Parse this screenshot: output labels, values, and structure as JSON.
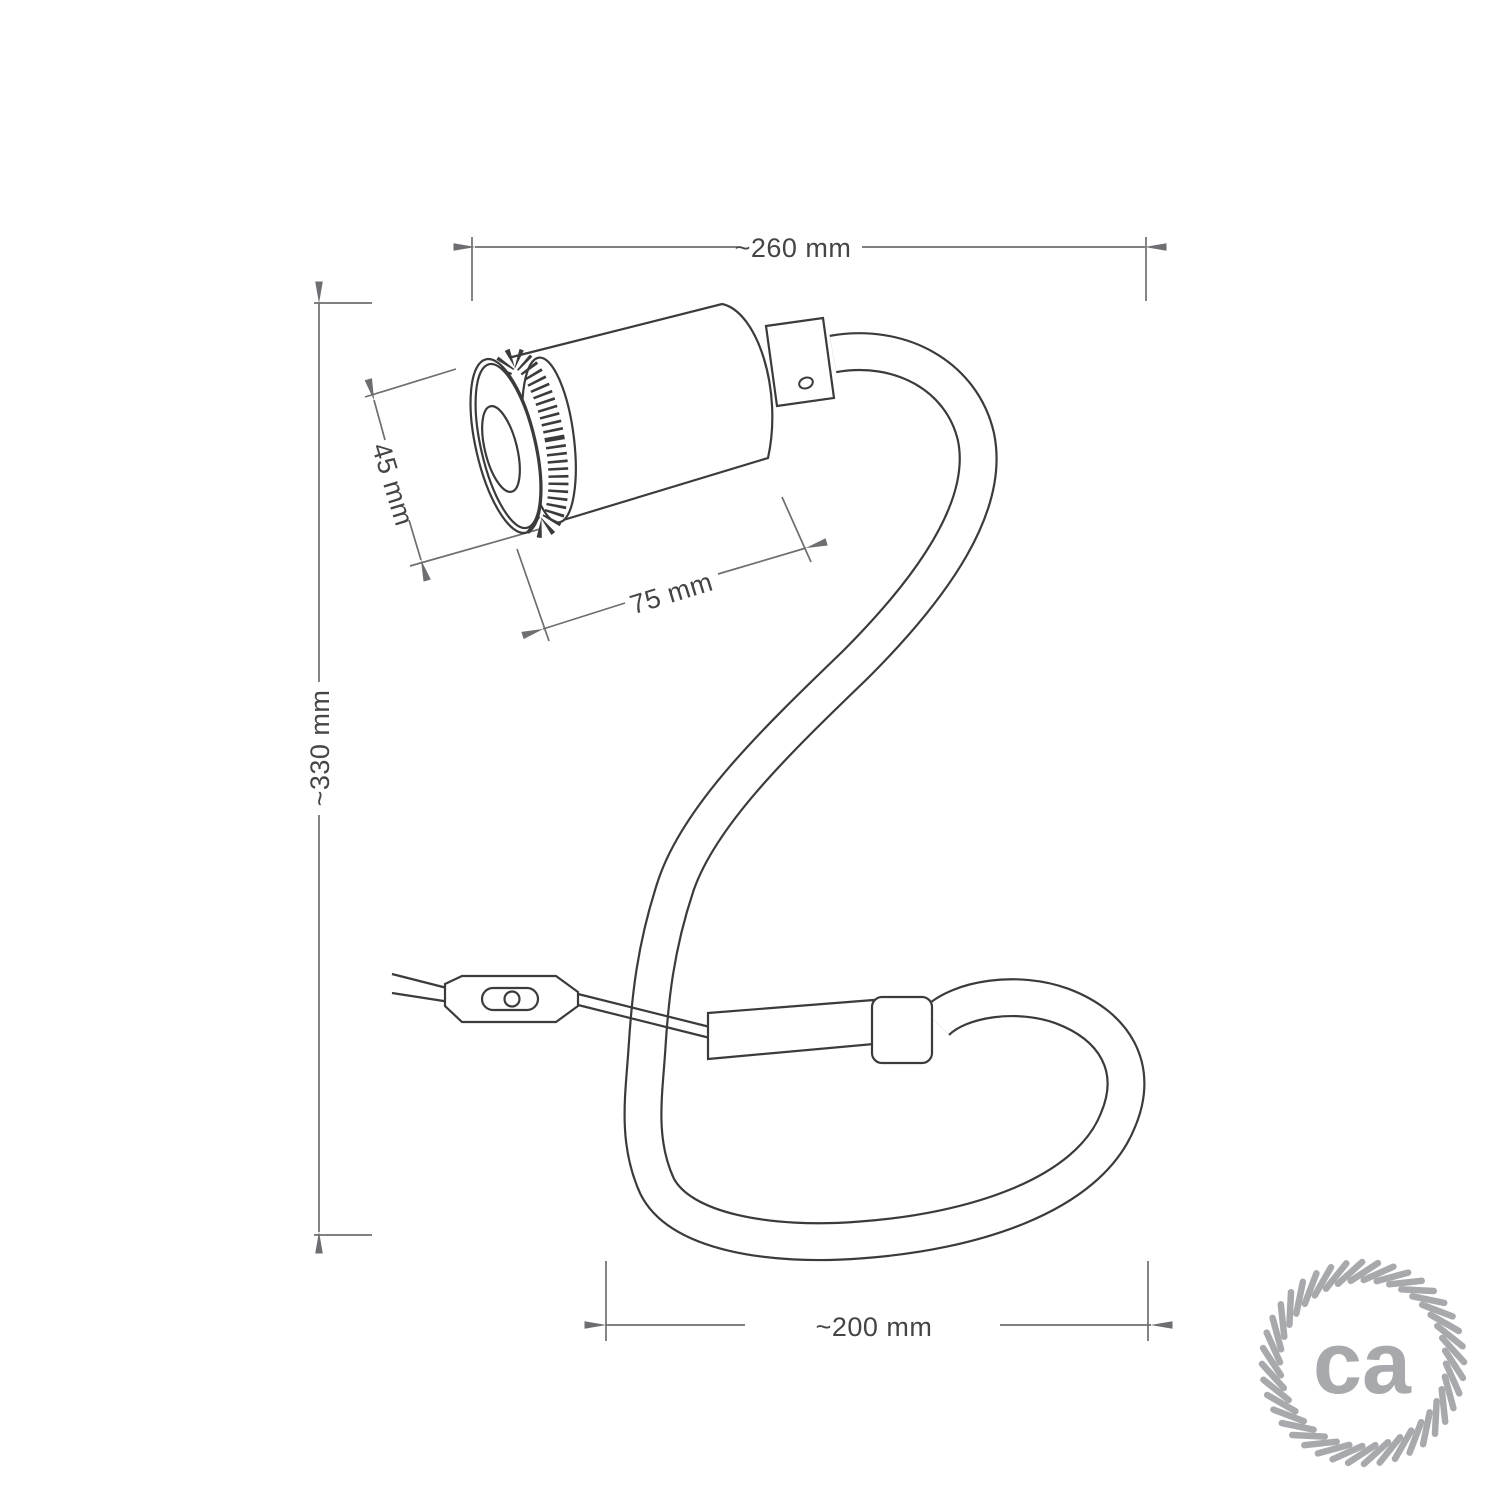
{
  "dimensions": {
    "overall_width": {
      "label": "~260 mm"
    },
    "overall_height": {
      "label": "~330 mm"
    },
    "spot_diameter": {
      "label": "45 mm"
    },
    "spot_length": {
      "label": "75 mm"
    },
    "base_loop_width": {
      "label": "~200 mm"
    }
  },
  "logo": {
    "text": "ca"
  },
  "colors": {
    "outline": "#3b3b3d",
    "dimension_lines": "#6d6e71",
    "dimension_text": "#454547",
    "logo_gray": "#a7a9ac",
    "background": "#ffffff"
  }
}
